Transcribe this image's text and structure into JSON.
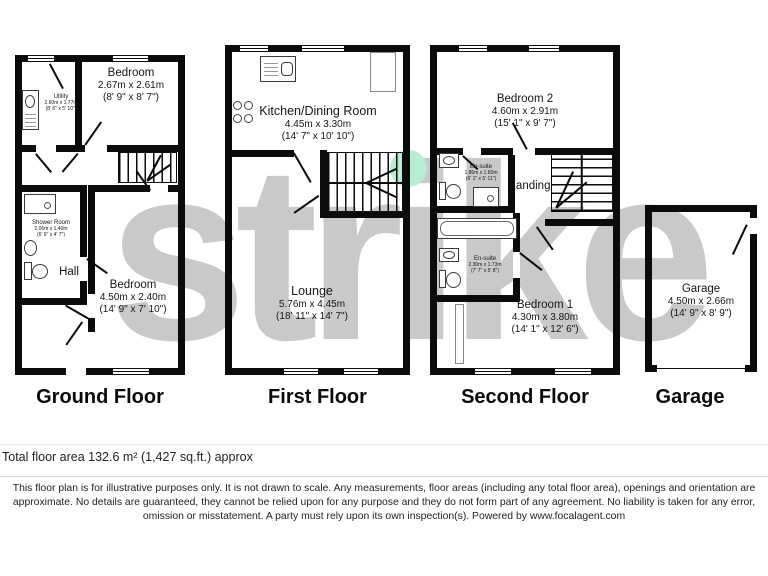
{
  "watermark": "strike",
  "colors": {
    "wall": "#0b0b0b",
    "watermark_gray": "#c9c9c9",
    "highlight_dot_green": "#b7eed3"
  },
  "floors": [
    {
      "title": "Ground Floor",
      "rooms": [
        {
          "name": "Utility",
          "metric": "2.60m x 1.77m",
          "imperial": "(8' 6\" x 5' 10\")"
        },
        {
          "name": "Bedroom",
          "metric": "2.67m x 2.61m",
          "imperial": "(8' 9\" x 8' 7\")"
        },
        {
          "name": "Shower Room",
          "metric": "2.06m x 1.40m",
          "imperial": "(6' 9\" x 4' 7\")"
        },
        {
          "name": "Hall"
        },
        {
          "name": "Bedroom",
          "metric": "4.50m x 2.40m",
          "imperial": "(14' 9\" x 7' 10\")"
        }
      ]
    },
    {
      "title": "First Floor",
      "rooms": [
        {
          "name": "Kitchen/Dining Room",
          "metric": "4.45m x 3.30m",
          "imperial": "(14' 7\" x 10' 10\")"
        },
        {
          "name": "Lounge",
          "metric": "5.76m x 4.45m",
          "imperial": "(18' 11\" x 14' 7\")"
        }
      ]
    },
    {
      "title": "Second Floor",
      "rooms": [
        {
          "name": "Bedroom 2",
          "metric": "4.60m x 2.91m",
          "imperial": "(15' 1\" x 9' 7\")"
        },
        {
          "name": "En-suite",
          "metric": "1.86m x 1.80m",
          "imperial": "(6' 1\" x 5' 11\")"
        },
        {
          "name": "Landing"
        },
        {
          "name": "En-suite",
          "metric": "2.30m x 1.73m",
          "imperial": "(7' 7\" x 5' 8\")"
        },
        {
          "name": "Bedroom 1",
          "metric": "4.30m x 3.80m",
          "imperial": "(14' 1\" x 12' 6\")"
        }
      ]
    },
    {
      "title": "Garage",
      "rooms": [
        {
          "name": "Garage",
          "metric": "4.50m x 2.66m",
          "imperial": "(14' 9\" x 8' 9\")"
        }
      ]
    }
  ],
  "footer": {
    "total_area": "Total floor area 132.6 m² (1,427 sq.ft.) approx",
    "disclaimer": "This floor plan is for illustrative purposes only. It is not drawn to scale. Any measurements, floor areas (including any total floor area), openings and orientation are approximate. No details are guaranteed, they cannot be relied upon for any purpose and they do not form part of any agreement. No liability is taken for any error, omission or misstatement. A party must rely upon its own inspection(s). Powered by www.focalagent.com"
  }
}
